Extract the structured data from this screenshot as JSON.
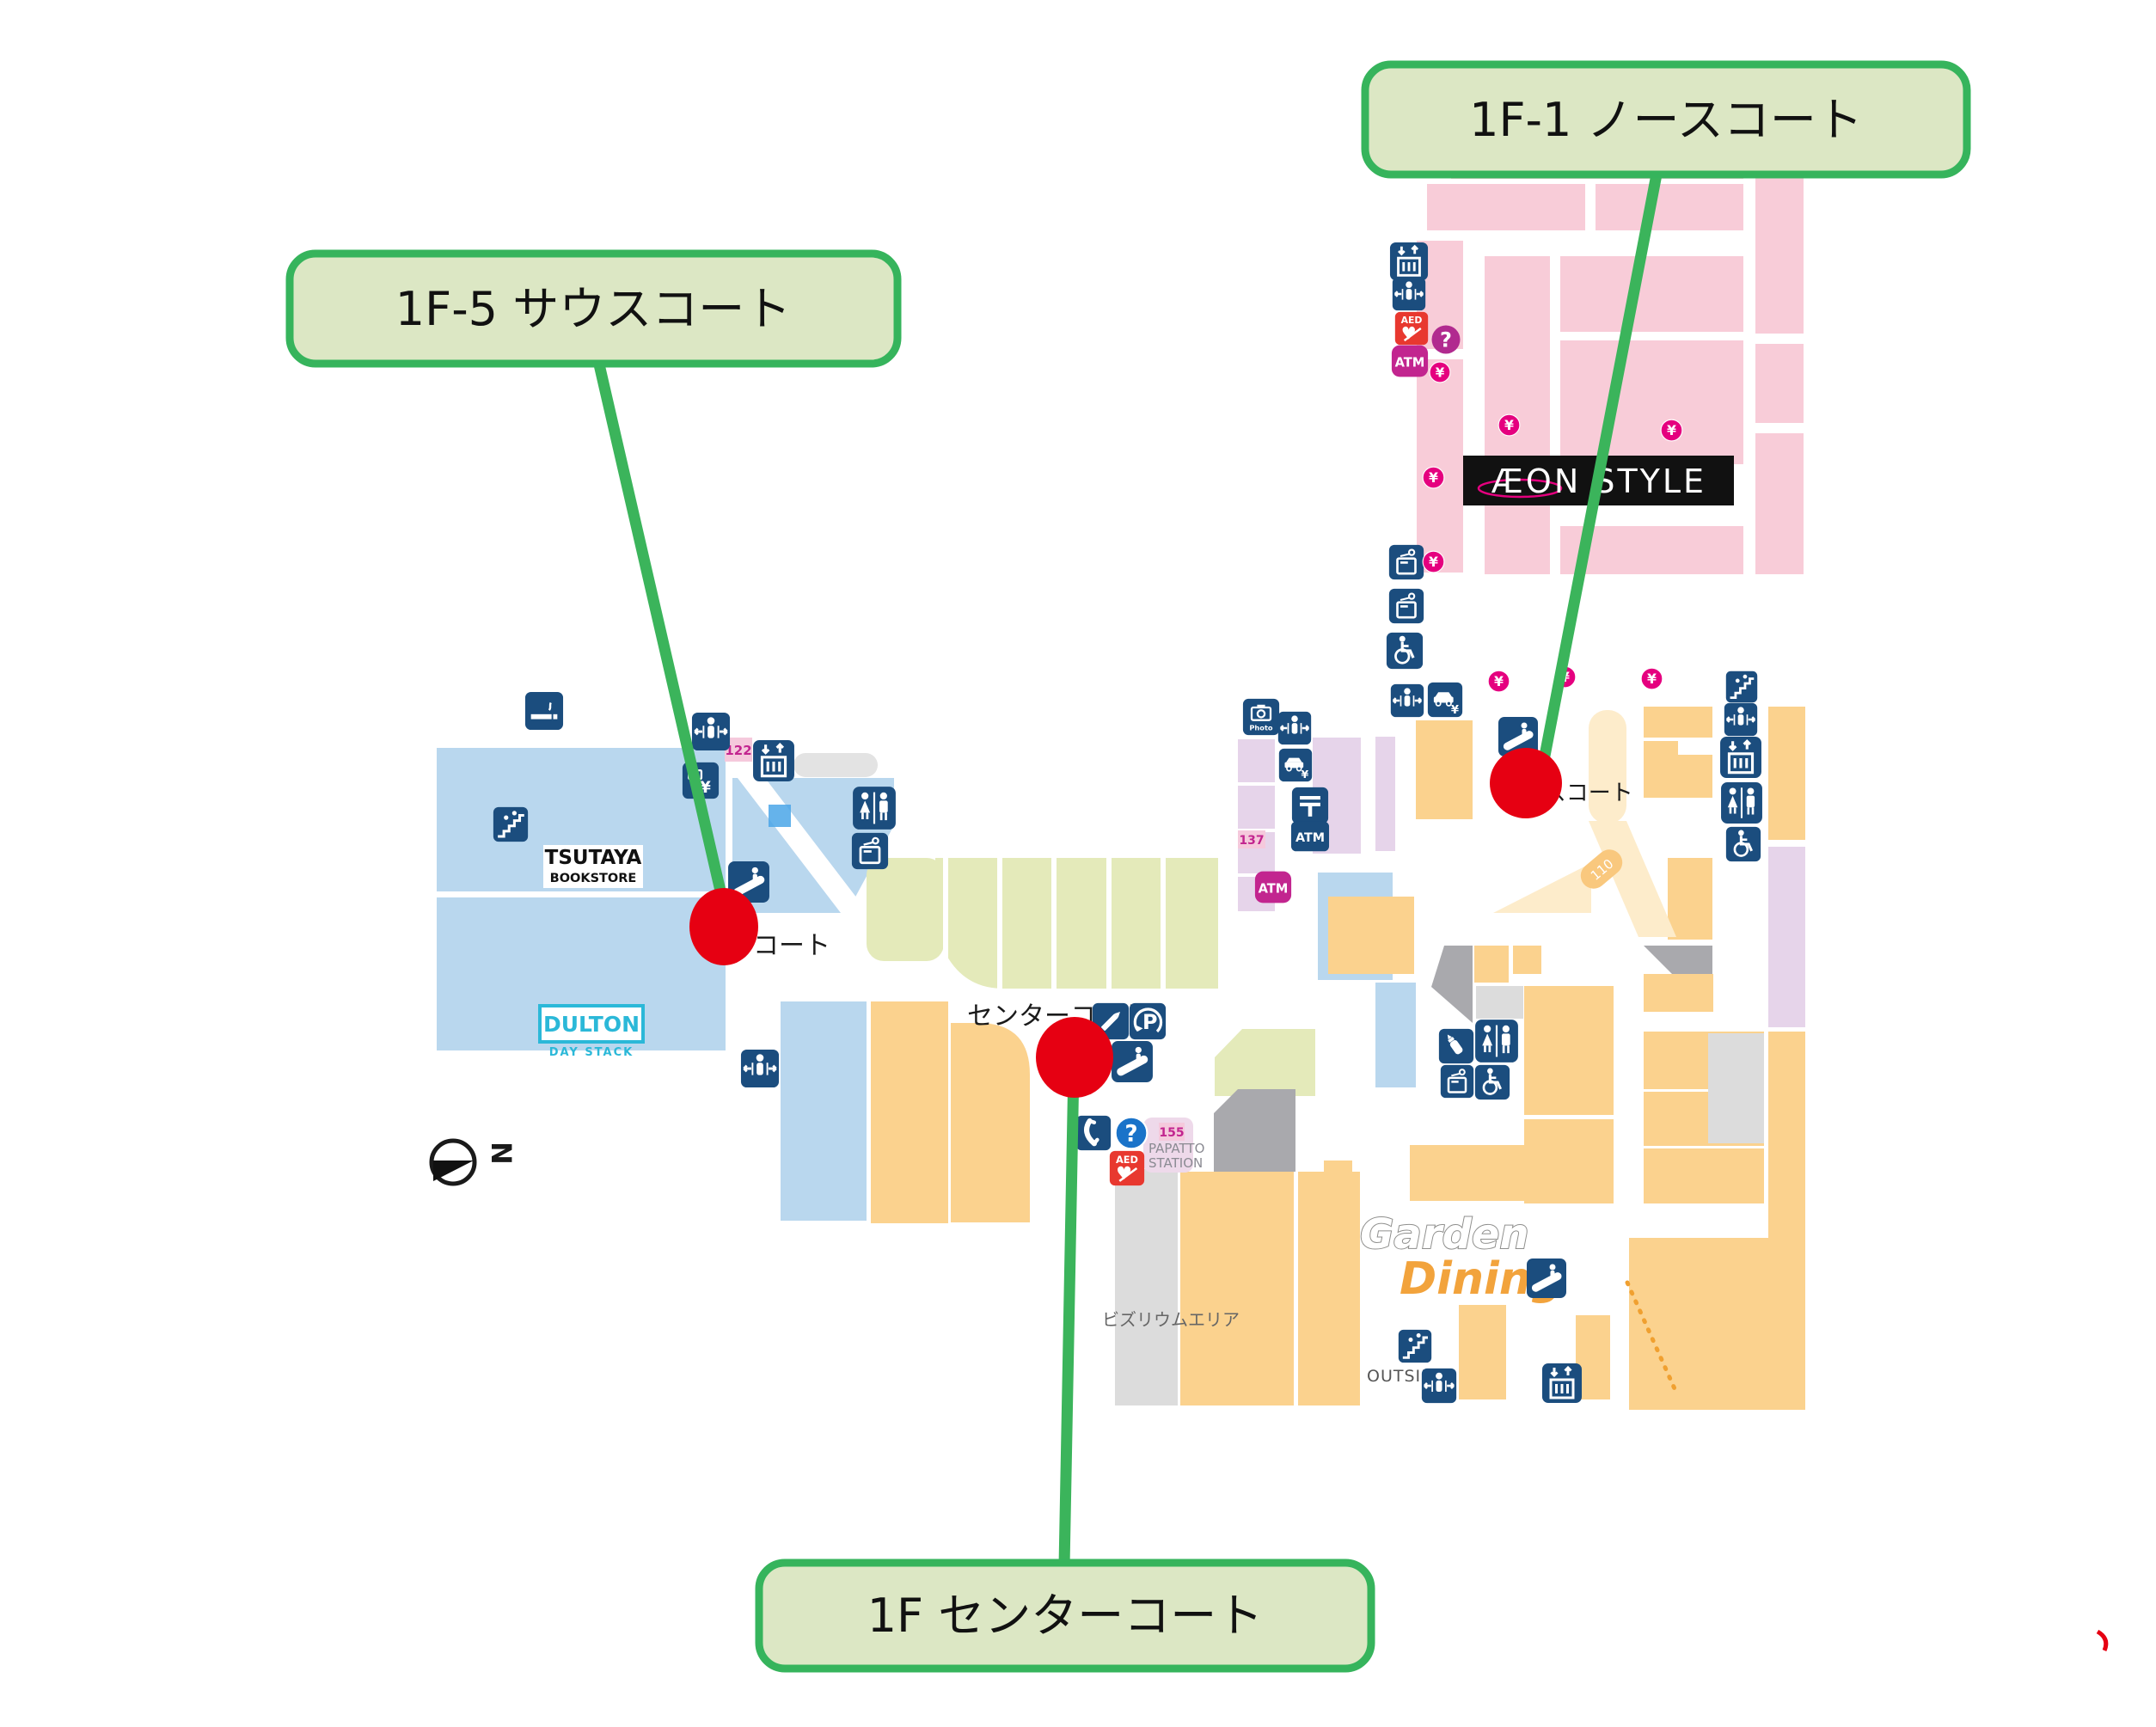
{
  "annotations": {
    "callouts": [
      {
        "id": "north",
        "label": "1F-1 ノースコート"
      },
      {
        "id": "south",
        "label": "1F-5 サウスコート"
      },
      {
        "id": "center",
        "label": "1F センターコート"
      }
    ],
    "colors": {
      "callout_border": "#36b45c",
      "callout_bg": "#dce7c4",
      "marker_red": "#e60012",
      "line_green": "#3bb45b"
    }
  },
  "map": {
    "stores": {
      "aeon_style": "ÆON STYLE",
      "tsutaya_line1": "TSUTAYA",
      "tsutaya_line2": "BOOKSTORE",
      "dulton": "DULTON",
      "dulton_sub": "DAY STACK",
      "garden_word1": "Garden",
      "garden_word2": "Dining",
      "papatto_line1": "PAPATTO",
      "papatto_line2": "STATION"
    },
    "areas": {
      "center_court": "センターコート",
      "north_court": "ノースコート",
      "south_court_part": "コート",
      "bizrium": "ビズリウムエリア",
      "outside": "OUTSIDE"
    },
    "numbers": {
      "shop_110": "110",
      "tag_122": "122",
      "tag_137": "137",
      "tag_155": "155"
    },
    "icon_texts": {
      "aed": "AED",
      "atm": "ATM",
      "yen": "¥",
      "question": "?",
      "parking": "P",
      "photo": "Photo",
      "compass_n": "N"
    },
    "colors": {
      "pink": "#f8ccd8",
      "blue": "#b9d7ee",
      "orange": "#fbd28e",
      "green": "#e4eaba",
      "lavender": "#e6d4ea",
      "peach": "#fdeccb",
      "navy": "#1b4d7e",
      "magenta": "#c2258f",
      "yen_pink": "#e5007f",
      "aed_red": "#e8382f",
      "question_blue": "#1a73c9",
      "dulton_cyan": "#2bb8d8",
      "gray_dark": "#a9a9ad",
      "gray_light": "#dcdcdc"
    }
  }
}
